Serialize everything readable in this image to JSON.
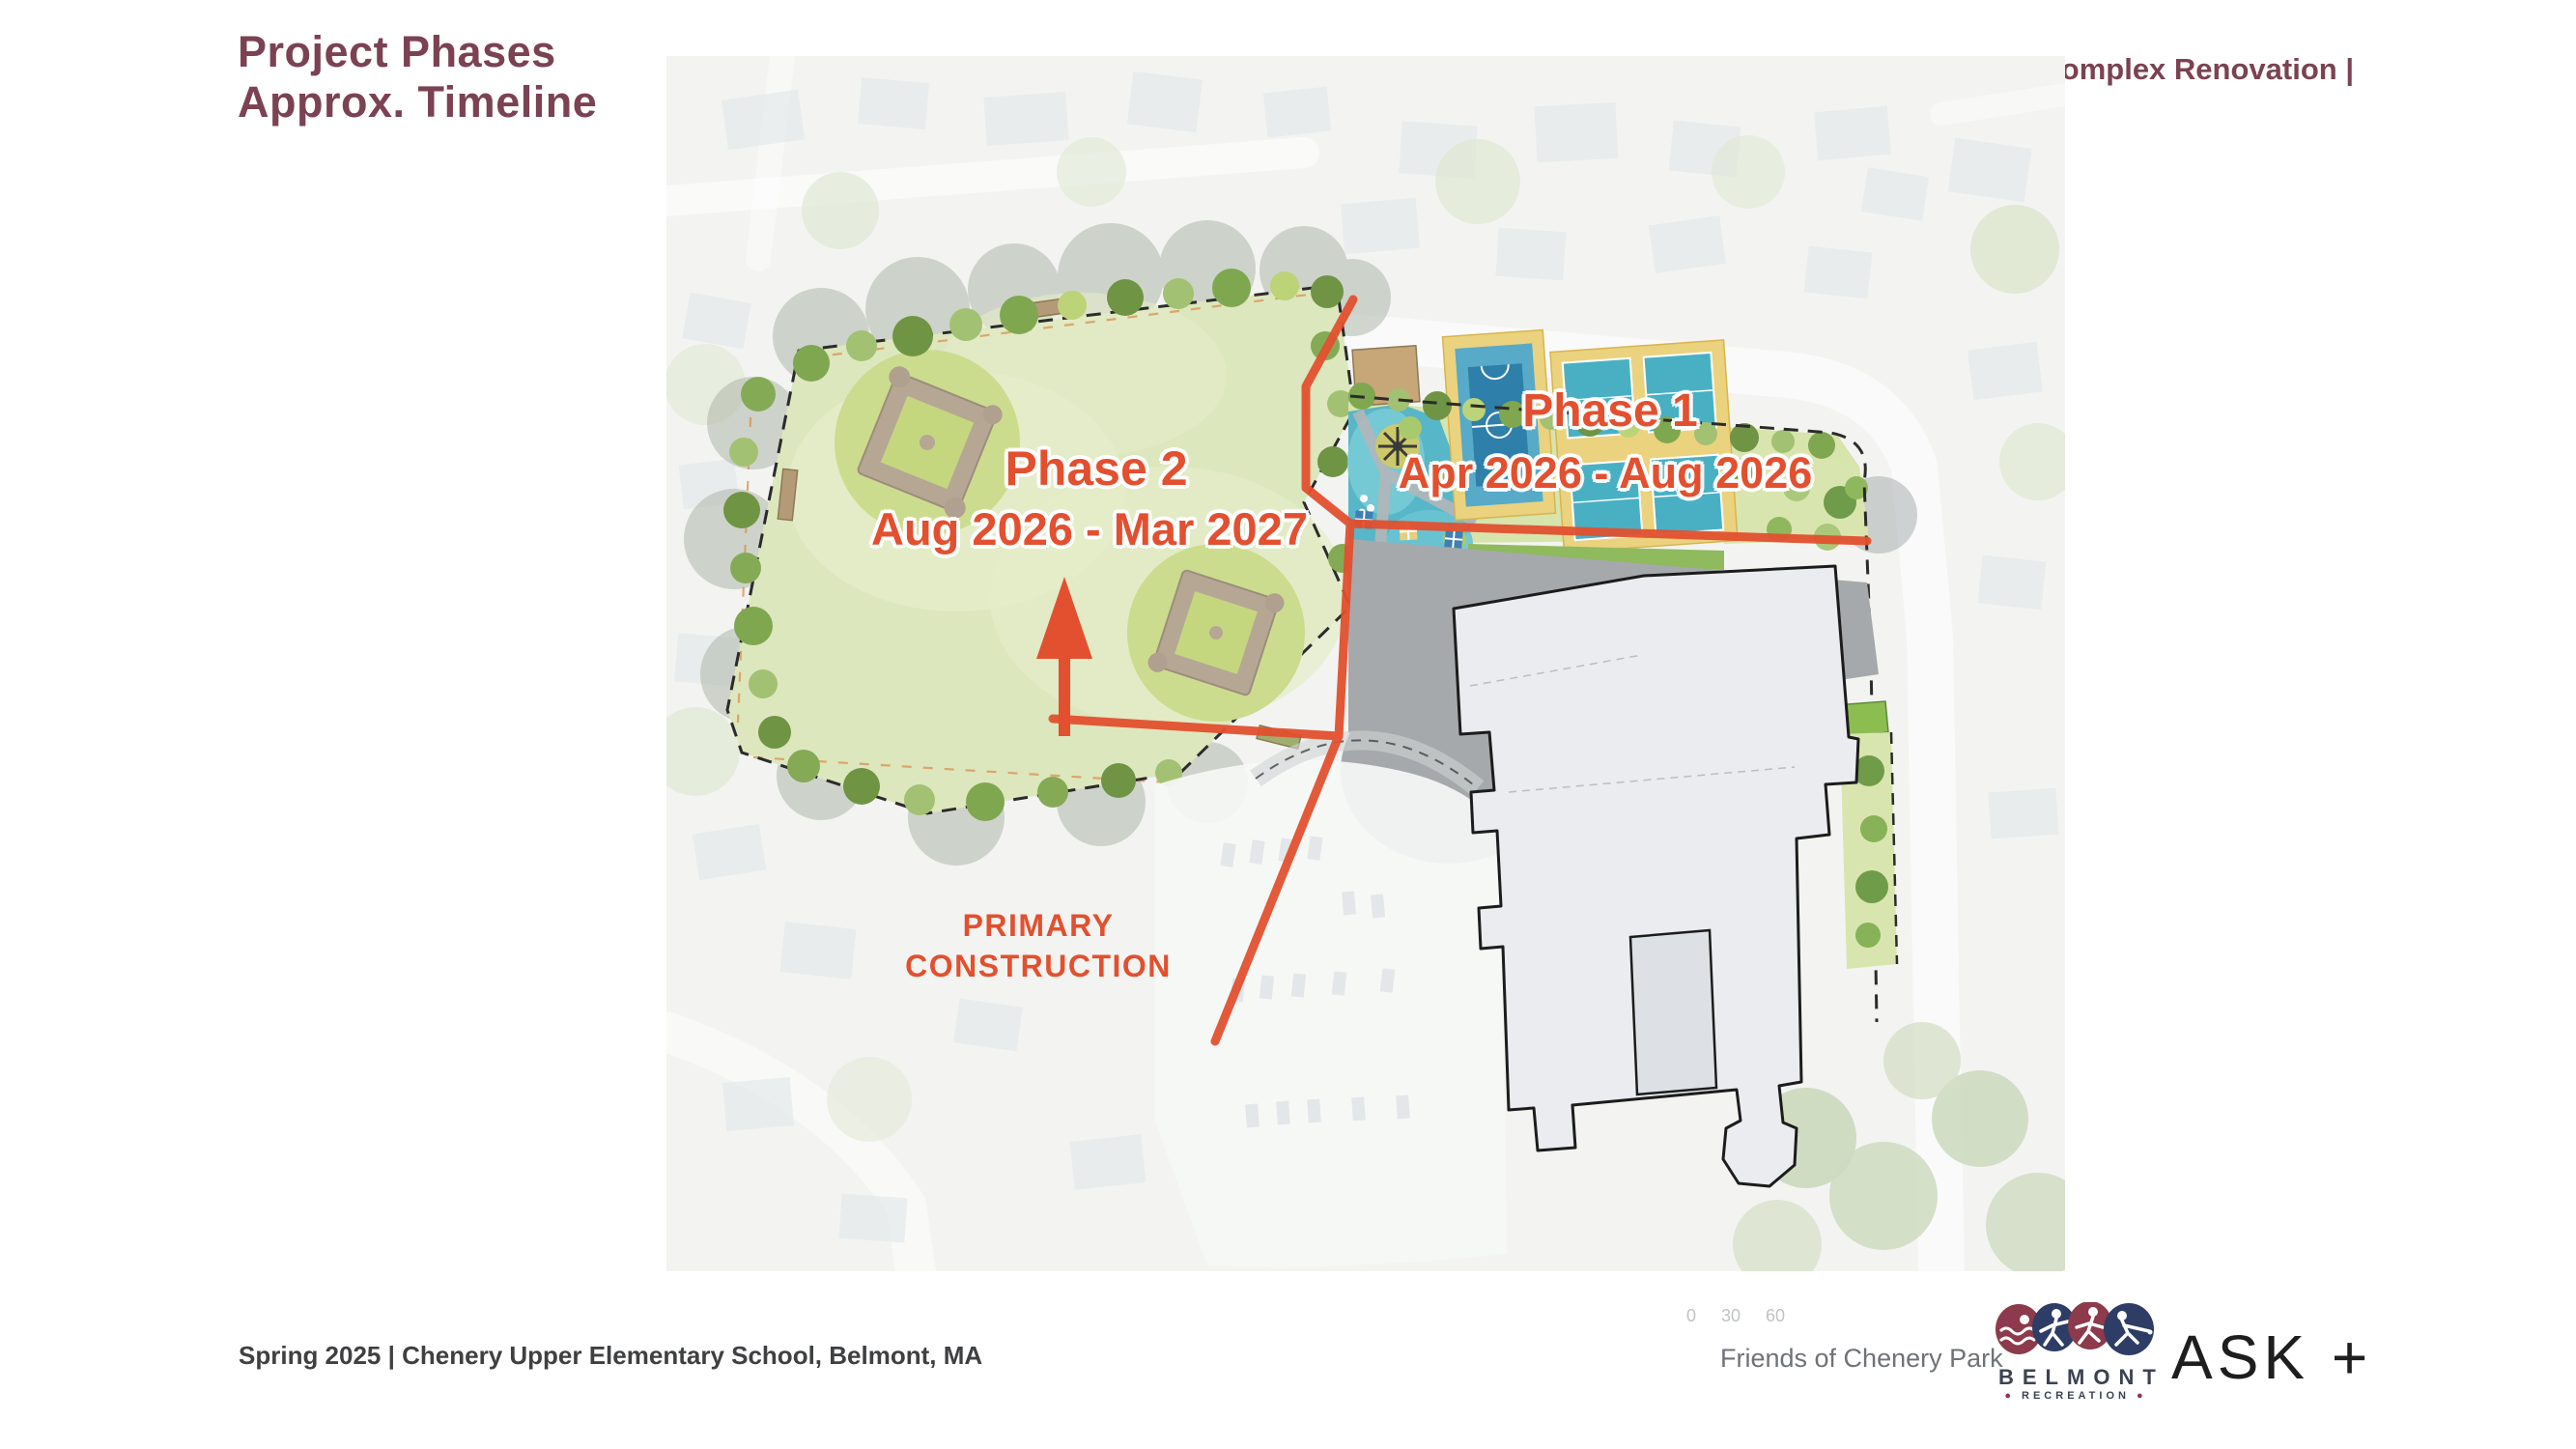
{
  "slide": {
    "title_line1": "Project Phases",
    "title_line2": "Approx. Timeline",
    "header_right": "Chenery Park Complex Renovation |"
  },
  "map": {
    "phase1_label": "Phase 1",
    "phase1_dates": "Apr 2026 - Aug 2026",
    "phase2_label": "Phase 2",
    "phase2_dates": "Aug 2026 - Mar 2027",
    "primary_line1": "PRIMARY",
    "primary_line2": "CONSTRUCTION",
    "scale_ticks": [
      "0",
      "30",
      "60"
    ]
  },
  "footer": {
    "credit_left": "Spring 2025 |  Chenery Upper Elementary School, Belmont, MA",
    "friends": "Friends of Chenery Park",
    "belmont_name": "BELMONT",
    "belmont_sub": "RECREATION",
    "ask_logo": "ASK +"
  },
  "colors": {
    "accent_orange": "#E2502F",
    "maroon": "#7B4253",
    "navy": "#2E3D66",
    "logo_maroon": "#8C3A4C"
  }
}
